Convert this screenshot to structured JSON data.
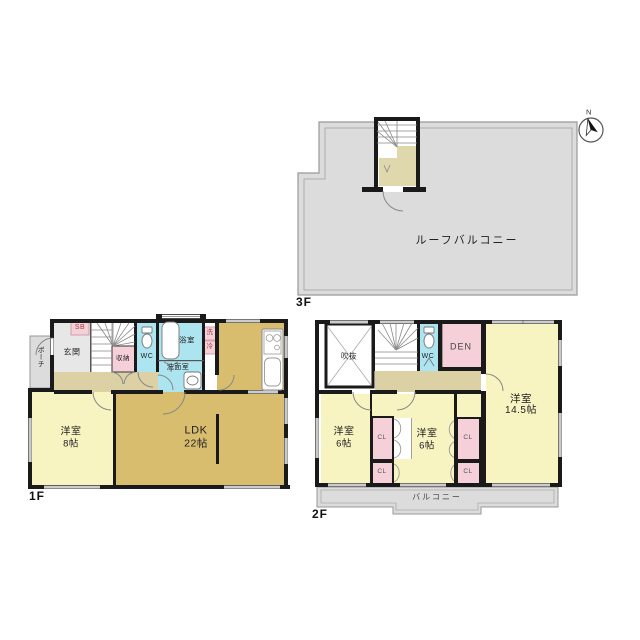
{
  "title": "floor-plan",
  "palette": {
    "wall": "#1a1a1a",
    "room_yellow": "#F8F4C2",
    "ldk_tan": "#D8BD6F",
    "hallway_beige": "#DBD1A5",
    "wet_area_cyan": "#ACE4EF",
    "closet_pink": "#F6D0D9",
    "balcony_gray": "#DCDCDC"
  },
  "compass": {
    "north_label": "N"
  },
  "f3": {
    "floor_label": "3F",
    "roof_balcony": "ルーフバルコニー"
  },
  "f1": {
    "floor_label": "1F",
    "porch": "ポーチ",
    "entrance": "玄関",
    "shoe_box": "SB",
    "storage": "収納",
    "wc": "WC",
    "bath": "浴室",
    "washroom": "洗面室",
    "washer": "洗",
    "fridge": "冷",
    "bedroom_name": "洋室",
    "bedroom_size": "8帖",
    "ldk_name": "LDK",
    "ldk_size": "22帖"
  },
  "f2": {
    "floor_label": "2F",
    "void": "吹抜",
    "wc": "WC",
    "den": "DEN",
    "bedroom_w_name": "洋室",
    "bedroom_w_size": "6帖",
    "bedroom_c_name": "洋室",
    "bedroom_c_size": "6帖",
    "bedroom_e_name": "洋室",
    "bedroom_e_size": "14.5帖",
    "closet": "CL",
    "balcony": "バルコニー"
  }
}
